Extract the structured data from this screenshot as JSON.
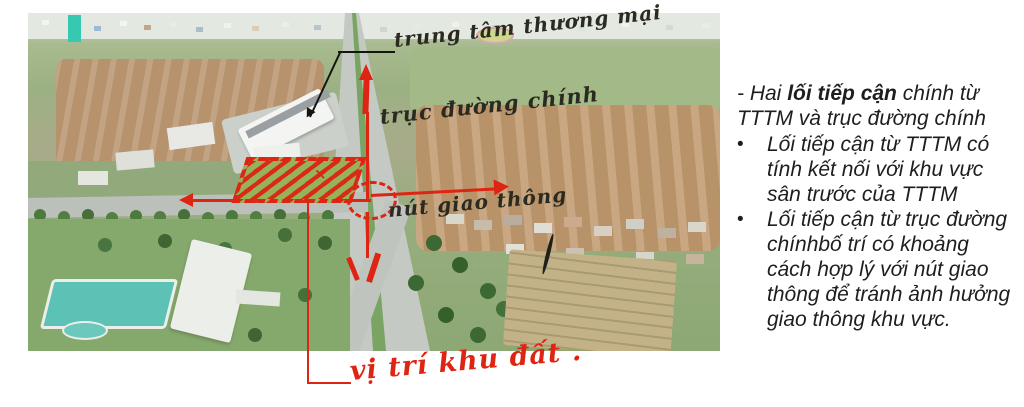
{
  "photo": {
    "description": "Aerial photo of project site under construction with hand-drawn planning annotations",
    "annotations": {
      "shopping_center_label": "trung tâm thương mại",
      "main_road_label": "trục đường chính",
      "junction_label": "nút giao thông",
      "site_location_label": "vị trí khu đất .",
      "site_marker": "×"
    },
    "colors": {
      "annotation_red": "#de2412",
      "ink_black": "#15150e",
      "pool_teal": "#5cc2b6"
    }
  },
  "notes": {
    "intro_prefix": "- Hai ",
    "intro_bold": "lối tiếp cận",
    "intro_suffix": " chính từ TTTM và trục đường chính",
    "bullet_glyph": "•",
    "bullets": [
      "Lối tiếp cận từ TTTM có tính kết nối với khu vực sân trước của TTTM",
      "Lối tiếp cận từ trục đường chínhbố trí có khoảng cách hợp lý với nút giao thông để tránh ảnh hưởng giao thông khu vực."
    ]
  }
}
